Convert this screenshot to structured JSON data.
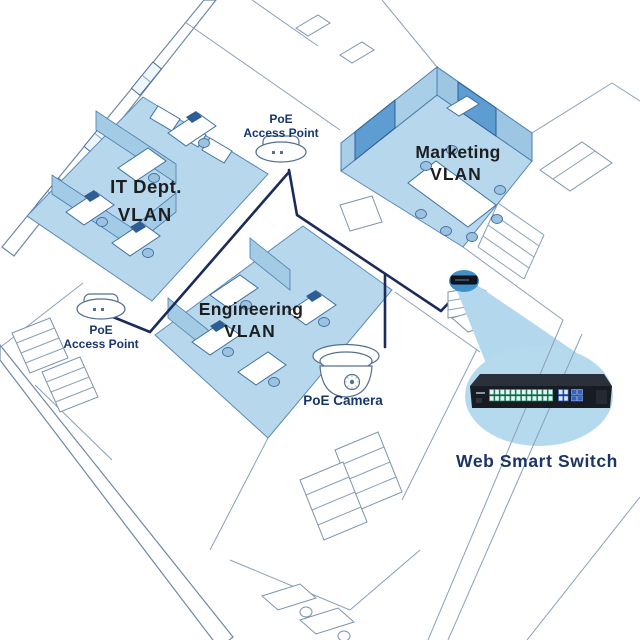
{
  "labels": {
    "vlan_it": {
      "line1": "IT Dept.",
      "line2": "VLAN"
    },
    "vlan_marketing": {
      "line1": "Marketing",
      "line2": "VLAN"
    },
    "vlan_engineering": {
      "line1": "Engineering",
      "line2": "VLAN"
    },
    "access_point_top": {
      "line1": "PoE",
      "line2": "Access Point"
    },
    "access_point_left": {
      "line1": "PoE",
      "line2": "Access Point"
    },
    "poe_camera": "PoE Camera",
    "web_smart_switch": "Web Smart Switch"
  },
  "devices": {
    "access_points": 2,
    "poe_cameras": 1,
    "switch": {
      "rj45_ports": 24,
      "uplink_ports": 4,
      "sfp_slots": 4
    }
  },
  "colors": {
    "vlan_highlight": "#b7d8ec",
    "callout_circle": "#b5daee",
    "cable_navy": "#1b2b5c",
    "label_navy": "#17356d",
    "label_dark": "#1d1e20",
    "wall_line": "#6e89a6",
    "device_spot_blue": "#3f8fc9",
    "switch_body": "#171c23",
    "rj45_accent_green": "#35a57c",
    "uplink_accent_blue": "#2f62c8"
  }
}
